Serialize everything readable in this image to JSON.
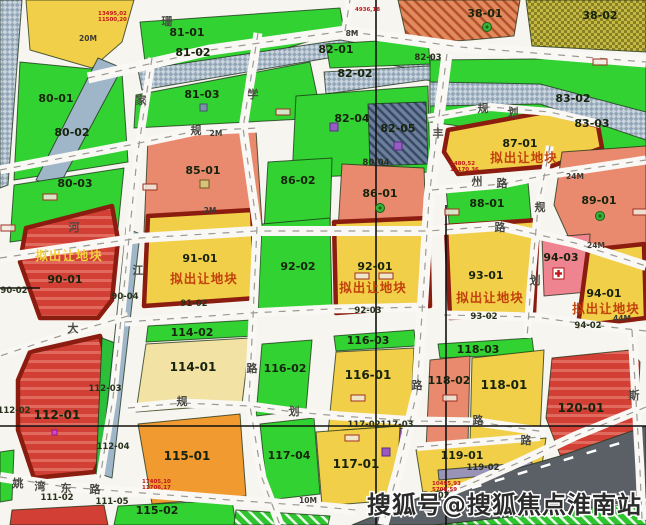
{
  "map_title": "淮南拟出让地块规划图",
  "offer_label": "拟出让地块",
  "watermark": "搜狐号@搜狐焦点淮南站",
  "palette": {
    "green": "#32d232",
    "yellow": "#f2cf48",
    "paleYellow": "#f2e3a4",
    "orange": "#f09a30",
    "salmon": "#e98a6e",
    "red": "#d23f35",
    "pink": "#ee8490",
    "offer_border": "#8b1c10",
    "road_bg": "#f7f5f0",
    "river": "#9fb6c9",
    "dark_band": "#5b5f66",
    "offer_text": "#c2410c"
  },
  "parcels": [
    {
      "id": "tl-hatch",
      "label": "",
      "fill": "blueHatch"
    },
    {
      "id": "tl-yellow",
      "label": "",
      "fill": "yellow"
    },
    {
      "id": "p80-01",
      "label": "80-01",
      "fill": "green",
      "lx": 56,
      "ly": 102
    },
    {
      "id": "p80-02r",
      "label": "",
      "fill": "river"
    },
    {
      "id": "p80-02",
      "label": "80-02",
      "fill": "none",
      "lx": 72,
      "ly": 136
    },
    {
      "id": "p80-03",
      "label": "80-03",
      "fill": "green",
      "lx": 75,
      "ly": 187
    },
    {
      "id": "p81-01",
      "label": "81-01",
      "fill": "green",
      "lx": 187,
      "ly": 36
    },
    {
      "id": "p81-02",
      "label": "81-02",
      "fill": "blueHatch",
      "lx": 193,
      "ly": 56
    },
    {
      "id": "p81-03",
      "label": "81-03",
      "fill": "green",
      "lx": 202,
      "ly": 98
    },
    {
      "id": "p82-01",
      "label": "82-01",
      "fill": "green",
      "lx": 336,
      "ly": 53
    },
    {
      "id": "p82-02",
      "label": "82-02",
      "fill": "blueHatch",
      "lx": 355,
      "ly": 77
    },
    {
      "id": "p82-04",
      "label": "82-04",
      "fill": "green",
      "lx": 352,
      "ly": 122
    },
    {
      "id": "p82-05",
      "label": "82-05",
      "fill": "darkHatch",
      "lx": 398,
      "ly": 132
    },
    {
      "id": "p38-01",
      "label": "38-01",
      "fill": "orangeHatch",
      "lx": 485,
      "ly": 17
    },
    {
      "id": "p38-02",
      "label": "38-02",
      "fill": "oliveHatch",
      "lx": 600,
      "ly": 19
    },
    {
      "id": "p83-green",
      "label": "83-03",
      "fill": "green",
      "lx": 592,
      "ly": 127
    },
    {
      "id": "p83-02",
      "label": "83-02",
      "fill": "blueHatch",
      "lx": 573,
      "ly": 102
    },
    {
      "id": "p87-01",
      "label": "87-01",
      "sub": "拟出让地块",
      "fill": "yellow",
      "outline": "offer",
      "lx": 520,
      "ly": 147,
      "sx": 524,
      "sy": 162
    },
    {
      "id": "p85-01",
      "label": "85-01",
      "fill": "salmon",
      "lx": 203,
      "ly": 174
    },
    {
      "id": "p86-02",
      "label": "86-02",
      "fill": "green",
      "lx": 298,
      "ly": 184
    },
    {
      "id": "p86-01",
      "label": "86-01",
      "fill": "salmon",
      "lx": 380,
      "ly": 197
    },
    {
      "id": "p88-01",
      "label": "88-01",
      "fill": "green",
      "lx": 487,
      "ly": 207
    },
    {
      "id": "p89-01",
      "label": "89-01",
      "fill": "salmon",
      "lx": 599,
      "ly": 204
    },
    {
      "id": "p90-01",
      "label": "90-01",
      "sub": "拟出让地块",
      "subOnRed": true,
      "fill": "redStreak",
      "outline": "offer",
      "lx": 65,
      "ly": 283,
      "sx": 69,
      "sy": 260
    },
    {
      "id": "p91-01",
      "label": "91-01",
      "sub": "拟出让地块",
      "fill": "yellow",
      "outline": "offer",
      "lx": 200,
      "ly": 262,
      "sx": 204,
      "sy": 283
    },
    {
      "id": "p92-02",
      "label": "92-02",
      "fill": "green",
      "lx": 298,
      "ly": 270
    },
    {
      "id": "p92-01",
      "label": "92-01",
      "sub": "拟出让地块",
      "fill": "yellow",
      "outline": "offer",
      "lx": 375,
      "ly": 270,
      "sx": 373,
      "sy": 292
    },
    {
      "id": "p93-01",
      "label": "93-01",
      "sub": "拟出让地块",
      "fill": "yellow",
      "outline": "offer",
      "lx": 486,
      "ly": 279,
      "sx": 490,
      "sy": 302
    },
    {
      "id": "p94-03",
      "label": "94-03",
      "fill": "pink",
      "lx": 561,
      "ly": 261
    },
    {
      "id": "p94-01",
      "label": "94-01",
      "sub": "拟出让地块",
      "fill": "yellow",
      "outline": "offer",
      "lx": 604,
      "ly": 297,
      "sx": 606,
      "sy": 313
    },
    {
      "id": "p114-02",
      "label": "114-02",
      "fill": "green",
      "lx": 192,
      "ly": 336
    },
    {
      "id": "p114-01",
      "label": "114-01",
      "fill": "paleYellow",
      "lx": 193,
      "ly": 371,
      "big": true
    },
    {
      "id": "p116-02",
      "label": "116-02",
      "fill": "green",
      "lx": 285,
      "ly": 372
    },
    {
      "id": "p116-03",
      "label": "116-03",
      "fill": "green",
      "lx": 368,
      "ly": 344
    },
    {
      "id": "p116-01",
      "label": "116-01",
      "fill": "yellow",
      "lx": 368,
      "ly": 379,
      "big": true
    },
    {
      "id": "p112-01",
      "label": "112-01",
      "fill": "redStreak",
      "outline": "offer",
      "lx": 57,
      "ly": 419,
      "big": true
    },
    {
      "id": "p112-03",
      "label": "",
      "fill": "greenStrip"
    },
    {
      "id": "p112-04r",
      "label": "",
      "fill": "river"
    },
    {
      "id": "p115-01",
      "label": "115-01",
      "fill": "orange",
      "lx": 187,
      "ly": 460,
      "big": true
    },
    {
      "id": "p117-04",
      "label": "117-04",
      "fill": "green",
      "lx": 289,
      "ly": 459
    },
    {
      "id": "p115-02",
      "label": "115-02",
      "fill": "green",
      "lx": 157,
      "ly": 514
    },
    {
      "id": "p118-03",
      "label": "118-03",
      "fill": "green",
      "lx": 478,
      "ly": 353
    },
    {
      "id": "p118-02",
      "label": "118-02",
      "fill": "salmon",
      "lx": 449,
      "ly": 384
    },
    {
      "id": "p118-01",
      "label": "118-01",
      "fill": "yellow",
      "lx": 504,
      "ly": 389,
      "big": true
    },
    {
      "id": "p120-01",
      "label": "120-01",
      "fill": "redStreak",
      "lx": 581,
      "ly": 412,
      "big": true
    },
    {
      "id": "p117s1",
      "label": "",
      "fill": "salmon"
    },
    {
      "id": "p117s2",
      "label": "",
      "fill": "purple"
    },
    {
      "id": "p117-01",
      "label": "117-01",
      "fill": "yellow",
      "lx": 356,
      "ly": 468,
      "big": true
    },
    {
      "id": "p119-01",
      "label": "119-01",
      "fill": "yellow",
      "lx": 462,
      "ly": 459
    },
    {
      "id": "p119-02b",
      "label": "",
      "fill": "grayband"
    },
    {
      "id": "pdark",
      "label": "",
      "fill": "darkband"
    },
    {
      "id": "pghbr",
      "label": "",
      "fill": "greenHatch"
    },
    {
      "id": "pghbl",
      "label": "",
      "fill": "greenHatch"
    },
    {
      "id": "pblred",
      "label": "",
      "fill": "red"
    },
    {
      "id": "pblgreen",
      "label": "",
      "fill": "green"
    }
  ],
  "small_labels": [
    {
      "t": "82-03",
      "x": 428,
      "y": 60
    },
    {
      "t": "80-04",
      "x": 376,
      "y": 165
    },
    {
      "t": "90-02",
      "x": 14,
      "y": 293
    },
    {
      "t": "90-04",
      "x": 125,
      "y": 299
    },
    {
      "t": "91-02",
      "x": 194,
      "y": 306
    },
    {
      "t": "92-03",
      "x": 368,
      "y": 313
    },
    {
      "t": "93-02",
      "x": 484,
      "y": 319
    },
    {
      "t": "94-02",
      "x": 588,
      "y": 328
    },
    {
      "t": "112-02",
      "x": 14,
      "y": 413
    },
    {
      "t": "112-03",
      "x": 105,
      "y": 391
    },
    {
      "t": "112-04",
      "x": 113,
      "y": 449
    },
    {
      "t": "117-02",
      "x": 364,
      "y": 427
    },
    {
      "t": "117-03",
      "x": 397,
      "y": 427
    },
    {
      "t": "119-02",
      "x": 483,
      "y": 470
    },
    {
      "t": "111-02",
      "x": 57,
      "y": 500
    },
    {
      "t": "111-05",
      "x": 112,
      "y": 504
    },
    {
      "t": "50-02",
      "x": 436,
      "y": 498
    },
    {
      "t": "59-01",
      "x": 519,
      "y": 500
    }
  ],
  "road_names": [
    {
      "t": "珊",
      "x": 167,
      "y": 25
    },
    {
      "t": "家",
      "x": 141,
      "y": 104
    },
    {
      "t": "学",
      "x": 253,
      "y": 98
    },
    {
      "t": "规",
      "x": 196,
      "y": 134
    },
    {
      "t": "丰",
      "x": 438,
      "y": 137
    },
    {
      "t": "规",
      "x": 483,
      "y": 112
    },
    {
      "t": "划",
      "x": 513,
      "y": 116
    },
    {
      "t": "州",
      "x": 477,
      "y": 185
    },
    {
      "t": "路",
      "x": 502,
      "y": 187
    },
    {
      "t": "规",
      "x": 540,
      "y": 211
    },
    {
      "t": "路",
      "x": 500,
      "y": 231
    },
    {
      "t": "河",
      "x": 74,
      "y": 231
    },
    {
      "t": "江",
      "x": 138,
      "y": 274
    },
    {
      "t": "划",
      "x": 535,
      "y": 284
    },
    {
      "t": "大",
      "x": 73,
      "y": 332
    },
    {
      "t": "路",
      "x": 252,
      "y": 372
    },
    {
      "t": "路",
      "x": 417,
      "y": 389
    },
    {
      "t": "规",
      "x": 182,
      "y": 405
    },
    {
      "t": "划",
      "x": 294,
      "y": 415
    },
    {
      "t": "路",
      "x": 478,
      "y": 424
    },
    {
      "t": "斯",
      "x": 634,
      "y": 399
    },
    {
      "t": "路",
      "x": 526,
      "y": 444
    },
    {
      "t": "姚",
      "x": 18,
      "y": 487
    },
    {
      "t": "湾",
      "x": 40,
      "y": 490
    },
    {
      "t": "东",
      "x": 66,
      "y": 492
    },
    {
      "t": "路",
      "x": 95,
      "y": 493
    }
  ],
  "width_markers": [
    {
      "t": "20M",
      "x": 88,
      "y": 41
    },
    {
      "t": "8M",
      "x": 352,
      "y": 36
    },
    {
      "t": "2M",
      "x": 216,
      "y": 136
    },
    {
      "t": "2M",
      "x": 210,
      "y": 213
    },
    {
      "t": "24M",
      "x": 575,
      "y": 179
    },
    {
      "t": "24M",
      "x": 596,
      "y": 248
    },
    {
      "t": "44M",
      "x": 622,
      "y": 321
    },
    {
      "t": "10M",
      "x": 308,
      "y": 503
    }
  ],
  "coord_stamps": [
    {
      "l1": "13495,02",
      "l2": "11500,20",
      "x": 98,
      "y": 10
    },
    {
      "l1": "4936,18",
      "l2": "",
      "x": 355,
      "y": 6
    },
    {
      "l1": "1480,52",
      "l2": "11170,36",
      "x": 450,
      "y": 160
    },
    {
      "l1": "17405,10",
      "l2": "11706,17",
      "x": 142,
      "y": 478
    },
    {
      "l1": "10495,93",
      "l2": "5708,59",
      "x": 432,
      "y": 480
    }
  ]
}
